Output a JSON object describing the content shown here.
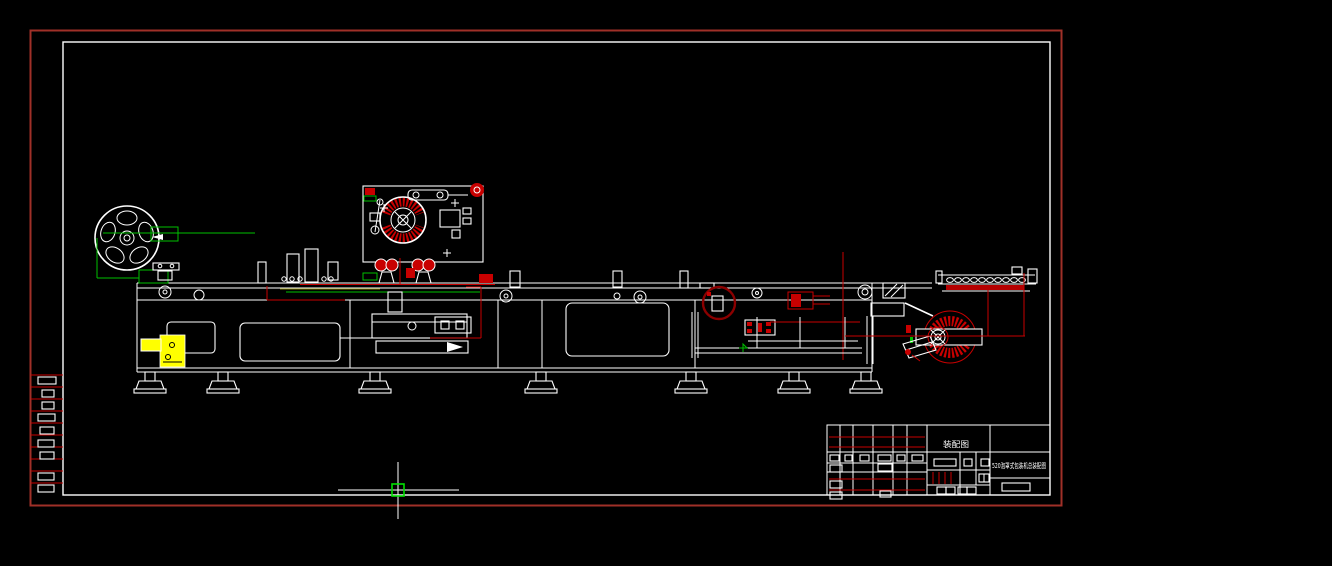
{
  "canvas": {
    "width": 1332,
    "height": 566,
    "background": "#000000"
  },
  "palette": {
    "paper_border_red": "#a03028",
    "line_white": "#ffffff",
    "component_red": "#c80000",
    "callout_dark_red": "#8b0000",
    "annotation_green": "#00c000",
    "pickbox_green": "#00e000",
    "highlight_yellow": "#ffff00",
    "annotation_olive": "#7f7f00"
  },
  "title_block": {
    "doc_label": "装配图",
    "drawing_title": "520泡罩式包装机总装配图"
  },
  "cursor": {
    "x": 398,
    "y": 490
  }
}
